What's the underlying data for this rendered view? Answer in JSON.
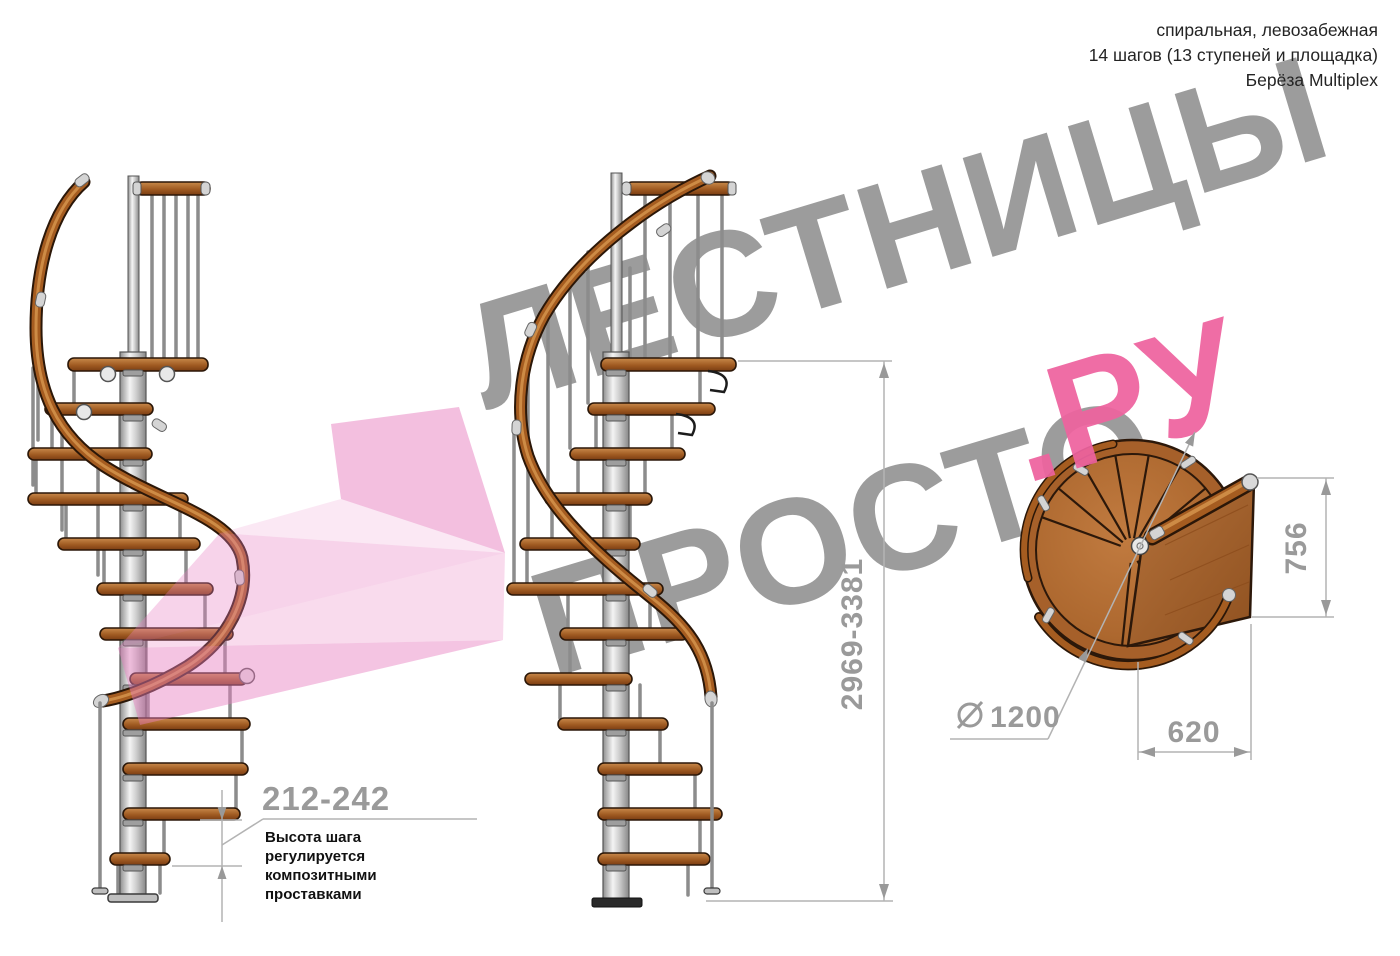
{
  "header": {
    "line1": "спиральная, левозабежная",
    "line2": "14 шагов (13 ступеней и площадка)",
    "line3": "Берёза Multiplex"
  },
  "watermark": {
    "word_top": "ЛЕСТНИЦЫ",
    "word_bottom": "ПРОСТО",
    "word_accent": ".РУ"
  },
  "dimensions": {
    "total_height": "2969-3381",
    "step_height": "212-242",
    "step_note": "Высота шага\nрегулируется\nкомпозитными\nпроставками",
    "plan_depth": "756",
    "plan_width": "620",
    "plan_diameter": "1200"
  },
  "icons": {
    "diameter_symbol": "diameter-icon"
  },
  "colors": {
    "watermark_gray": "#9c9c9c",
    "accent_pink": "#ee639f",
    "arrow_pink": "#e87fc0",
    "wood": "#a55c20",
    "wood_dark": "#2b1708",
    "metal": "#d9d9d9",
    "dimension_gray": "#9a9a9a",
    "text_black": "#242424"
  }
}
